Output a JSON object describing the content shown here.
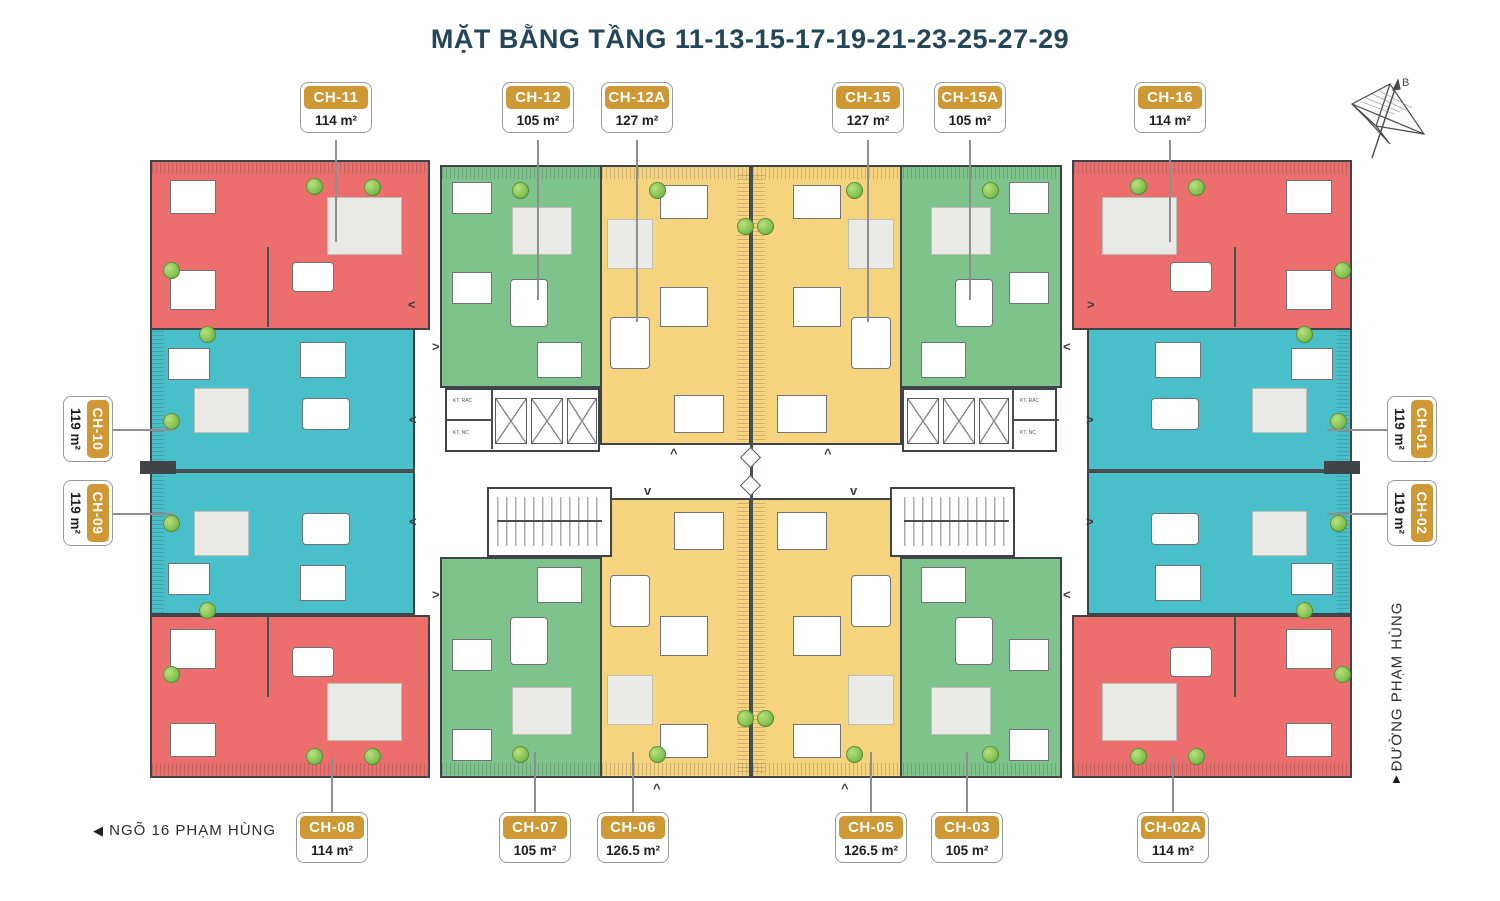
{
  "title": "MẶT BẰNG TẦNG 11-13-15-17-19-21-23-25-27-29",
  "streets": {
    "bottom_left": "NGÕ 16 PHẠM HÙNG",
    "right": "ĐƯỜNG PHẠM HÙNG"
  },
  "glyphs": {
    "left_arrow": "◀",
    "up_arrow": "▲",
    "chev_left": "<",
    "chev_right": ">",
    "chev_up": "^",
    "chev_down": "v"
  },
  "compass": {
    "label": "B"
  },
  "core_labels": {
    "trash": "KT. RÁC",
    "water": "KT. NC"
  },
  "palette": {
    "unit_red": "#EC6F6D",
    "unit_teal": "#48BFC9",
    "unit_green": "#7DC38B",
    "unit_yellow": "#F6D37E",
    "badge_gold": "#CE9834",
    "wall": "#3F4449",
    "title_text": "#24465A"
  },
  "units": {
    "top": [
      {
        "id": "CH-11",
        "area": "114 m²",
        "color": "red"
      },
      {
        "id": "CH-12",
        "area": "105 m²",
        "color": "green"
      },
      {
        "id": "CH-12A",
        "area": "127 m²",
        "color": "yellow"
      },
      {
        "id": "CH-15",
        "area": "127 m²",
        "color": "yellow"
      },
      {
        "id": "CH-15A",
        "area": "105 m²",
        "color": "green"
      },
      {
        "id": "CH-16",
        "area": "114 m²",
        "color": "red"
      }
    ],
    "bottom": [
      {
        "id": "CH-08",
        "area": "114 m²",
        "color": "red"
      },
      {
        "id": "CH-07",
        "area": "105 m²",
        "color": "green"
      },
      {
        "id": "CH-06",
        "area": "126.5 m²",
        "color": "yellow"
      },
      {
        "id": "CH-05",
        "area": "126.5 m²",
        "color": "yellow"
      },
      {
        "id": "CH-03",
        "area": "105 m²",
        "color": "green"
      },
      {
        "id": "CH-02A",
        "area": "114 m²",
        "color": "red"
      }
    ],
    "left": [
      {
        "id": "CH-10",
        "area": "119 m²",
        "color": "teal"
      },
      {
        "id": "CH-09",
        "area": "119 m²",
        "color": "teal"
      }
    ],
    "right": [
      {
        "id": "CH-01",
        "area": "119 m²",
        "color": "teal"
      },
      {
        "id": "CH-02",
        "area": "119 m²",
        "color": "teal"
      }
    ]
  }
}
